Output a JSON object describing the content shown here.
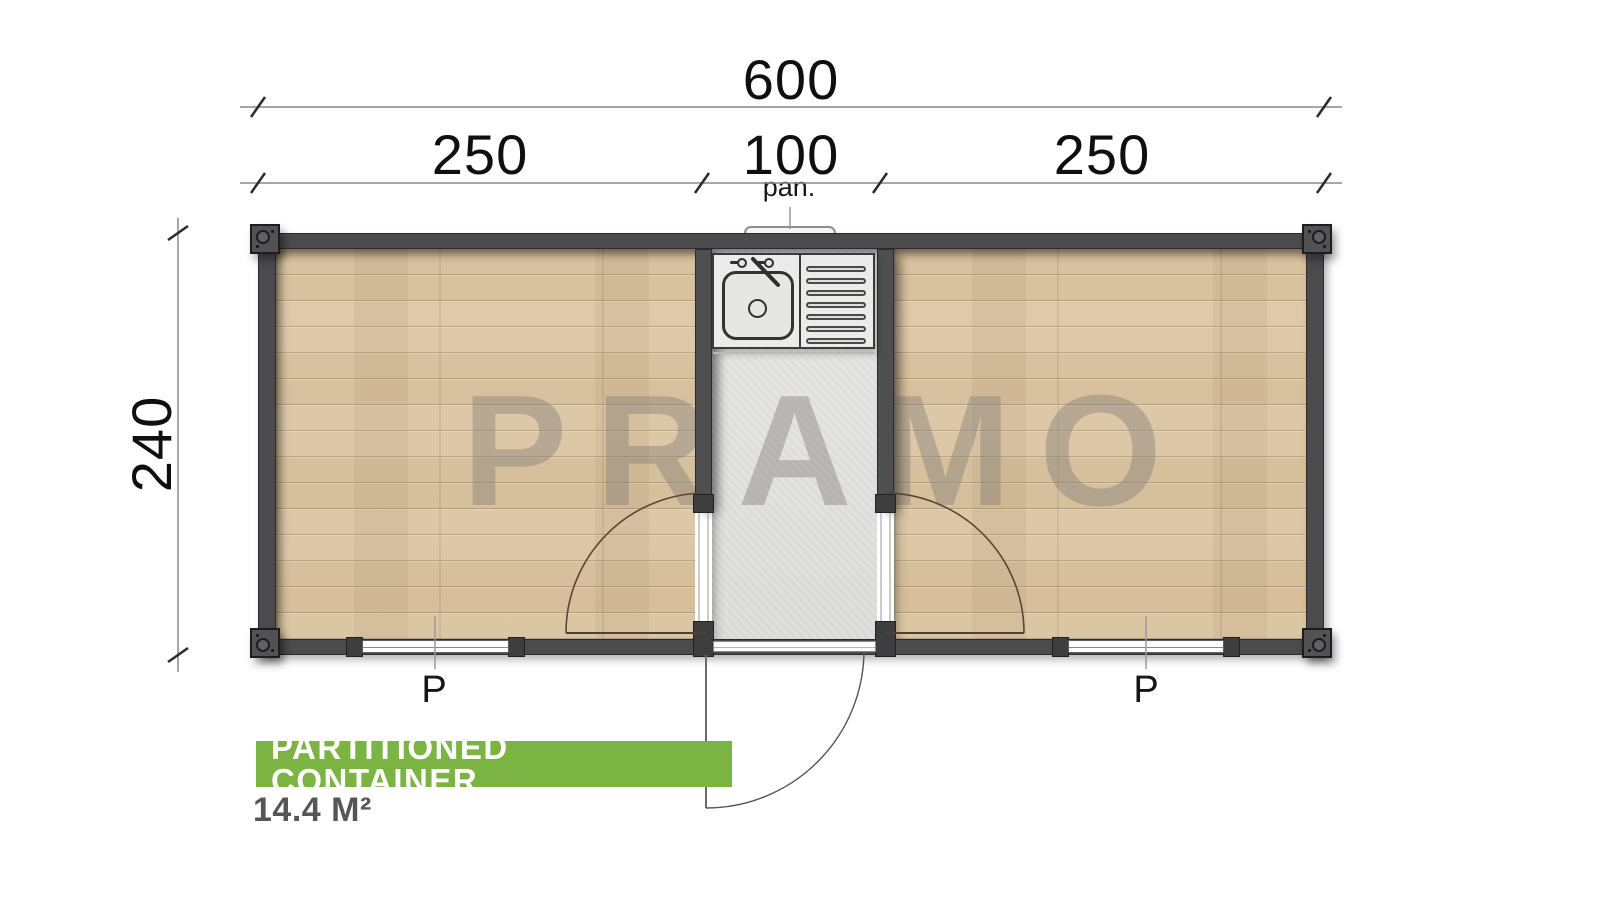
{
  "watermark": "PRAMO",
  "dimensions": {
    "total": "600",
    "left": "250",
    "middle": "100",
    "right": "250",
    "height": "240",
    "panel_abbrev": "pan."
  },
  "windows": {
    "left": "P",
    "right": "P"
  },
  "footer": {
    "banner_label": "PARTITIONED CONTAINER",
    "area_label": "14.4 M²"
  },
  "fixtures": {
    "sink": "kitchen-sink-with-drainboard",
    "doors": [
      "left-room-door",
      "right-room-door",
      "exterior-entry-door"
    ],
    "panel": "exterior-panel"
  },
  "colors": {
    "accent_green": "#7bb442",
    "wall_dark": "#4b4b4d",
    "wood_floor": "#d8c3a2",
    "hall_floor": "#e3e3e1",
    "watermark_gray": "#8f8f8f"
  }
}
